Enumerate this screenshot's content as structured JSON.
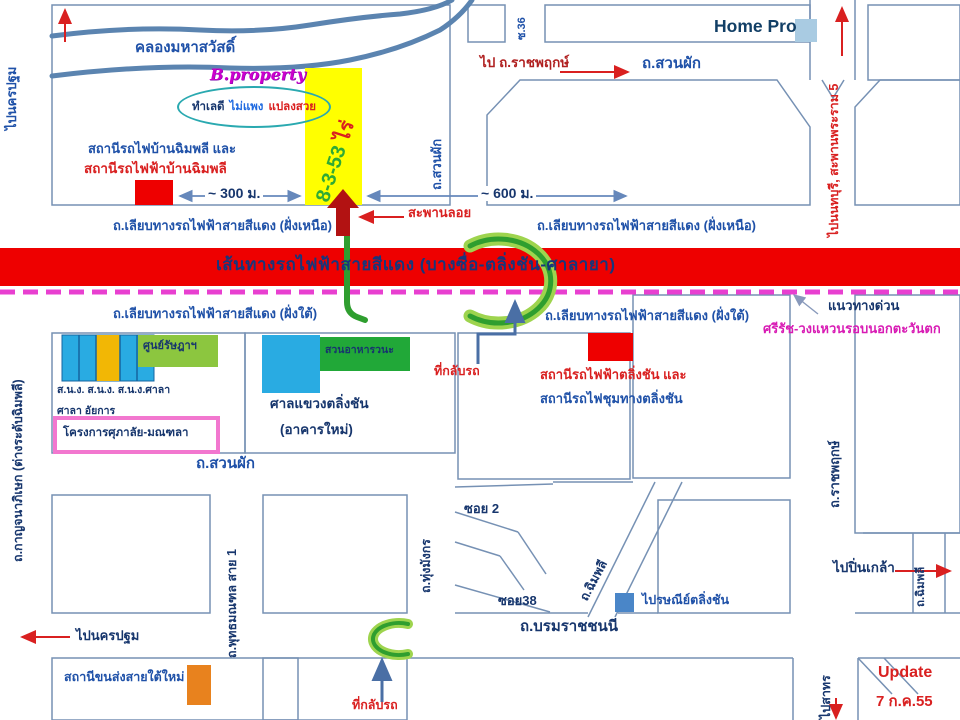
{
  "map": {
    "brand": "B.property",
    "tagline": [
      "ทำเลดี",
      "ไม่แพง",
      "แปลงสวย"
    ],
    "plot": {
      "area_number": "8-3-53",
      "area_unit": "ไร่"
    },
    "rail_line_title": "เส้นทางรถไฟฟ้าสายสีแดง (บางซื่อ-ตลิ่งชัน-ศาลายา)",
    "distances": {
      "d300": "~ 300 ม.",
      "d600": "~ 600 ม."
    },
    "update": {
      "label": "Update",
      "date": "7 ก.ค.55"
    },
    "roads": {
      "canal": "คลองมหาสวัสดิ์",
      "suanphak": "ถ.สวนผัก",
      "soi36": "ซ.36",
      "rail_side_north": "ถ.เลียบทางรถไฟฟ้าสายสีแดง (ฝั่งเหนือ)",
      "rail_side_south": "ถ.เลียบทางรถไฟฟ้าสายสีแดง (ฝั่งใต้)",
      "expressway_line1": "แนวทางด่วน",
      "expressway_line2": "ศรีรัช-วงแหวนรอบนอกตะวันตก",
      "ratchaphruek": "ถ.ราชพฤกษ์",
      "kanchanaphisek": "ถ.กาญจนาภิเษก (ต่างระดับฉิมพลี)",
      "phutthamonthon_sai1": "ถ.พุทธมณฑล สาย 1",
      "thung_mangkon": "ถ.ทุ่งมังกร",
      "soi2": "ซอย 2",
      "soi38": "ซอย38",
      "chimphli": "ถ.ฉิมพลี",
      "borommaratchachonnani": "ถ.บรมราชชนนี"
    },
    "places": {
      "homepro": "Home Pro",
      "station_chimphli_line1": "สถานีรถไฟบ้านฉิมพลี และ",
      "station_chimphli_line2": "สถานีรถไฟฟ้าบ้านฉิมพลี",
      "footbridge": "สะพานลอย",
      "uturn": "ที่กลับรถ",
      "station_talingchan_line1": "สถานีรถไฟฟ้าตลิ่งชัน และ",
      "station_talingchan_line2": "สถานีรถไฟชุมทางตลิ่งชัน",
      "govt_offices_line1": "ส.น.ง. ส.น.ง. ส.น.ง.ศาลา",
      "govt_offices_line2": "ศาลา อัยการ",
      "ratsada_center": "ศูนย์รัษฎาฯ",
      "supalai_project": "โครงการศุภาลัย-มณฑลา",
      "restaurant": "สวนอาหารวนะ",
      "court_line1": "ศาลแขวงตลิ่งชัน",
      "court_line2": "(อาคารใหม่)",
      "post_office": "ไปรษณีย์ตลิ่งชัน",
      "southern_bus_terminal": "สถานีขนส่งสายใต้ใหม่"
    },
    "directions": {
      "to_nakhon_pathom": "ไปนครปฐม",
      "to_ratchaphruek": "ไป ถ.ราชพฤกษ์",
      "to_nonthaburi": "ไปนนทบุรี, สะพานพระราม 5",
      "to_pinklao": "ไปปิ่นเกล้า",
      "to_sathorn": "ไปสาทร"
    },
    "colors": {
      "rail_band": "#ee0000",
      "dashed_line": "#e83fd0",
      "highlight_green": "#2f9e2f",
      "plot_yellow": "#ffff00",
      "road_outline": "#7691b4",
      "canal_blue": "#5b84b0",
      "marker_red": "#ee0000",
      "building_blue": "#29abe2",
      "terminal_orange": "#e8821e"
    }
  }
}
